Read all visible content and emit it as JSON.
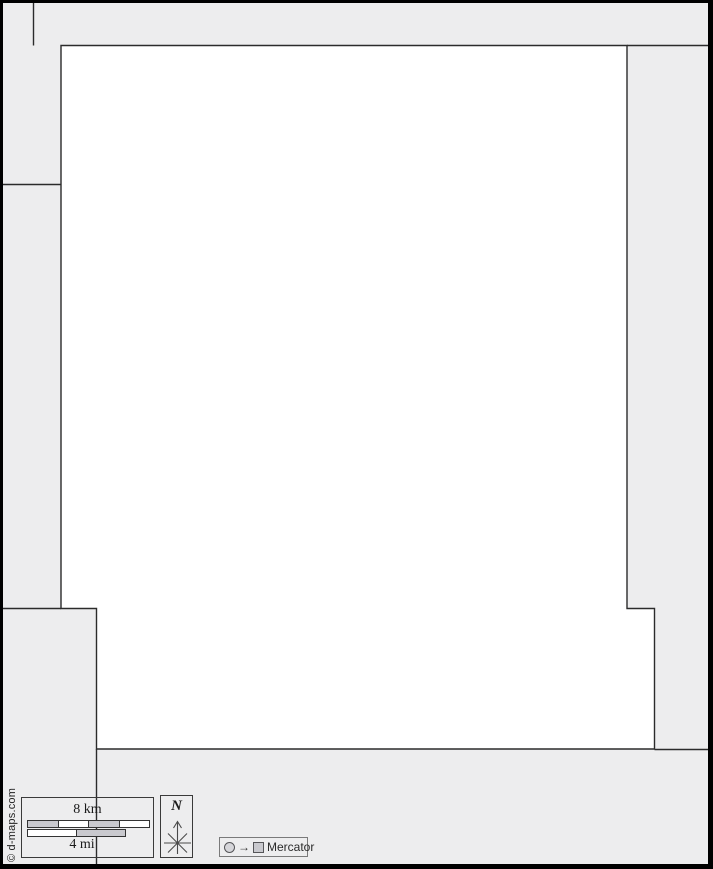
{
  "copyright": "© d-maps.com",
  "scale": {
    "km_label": "8 km",
    "mi_label": "4 mi"
  },
  "north": {
    "label": "N"
  },
  "projection": {
    "label": "Mercator"
  },
  "colors": {
    "canvas_bg": "#ededee",
    "main_region_fill": "#ffffff",
    "boundary_line": "#2b2b2b",
    "outer_border": "#000000",
    "scalebar_gray": "#c9c9ce",
    "scalebar_white": "#ffffff",
    "text": "#1a1a1a"
  }
}
